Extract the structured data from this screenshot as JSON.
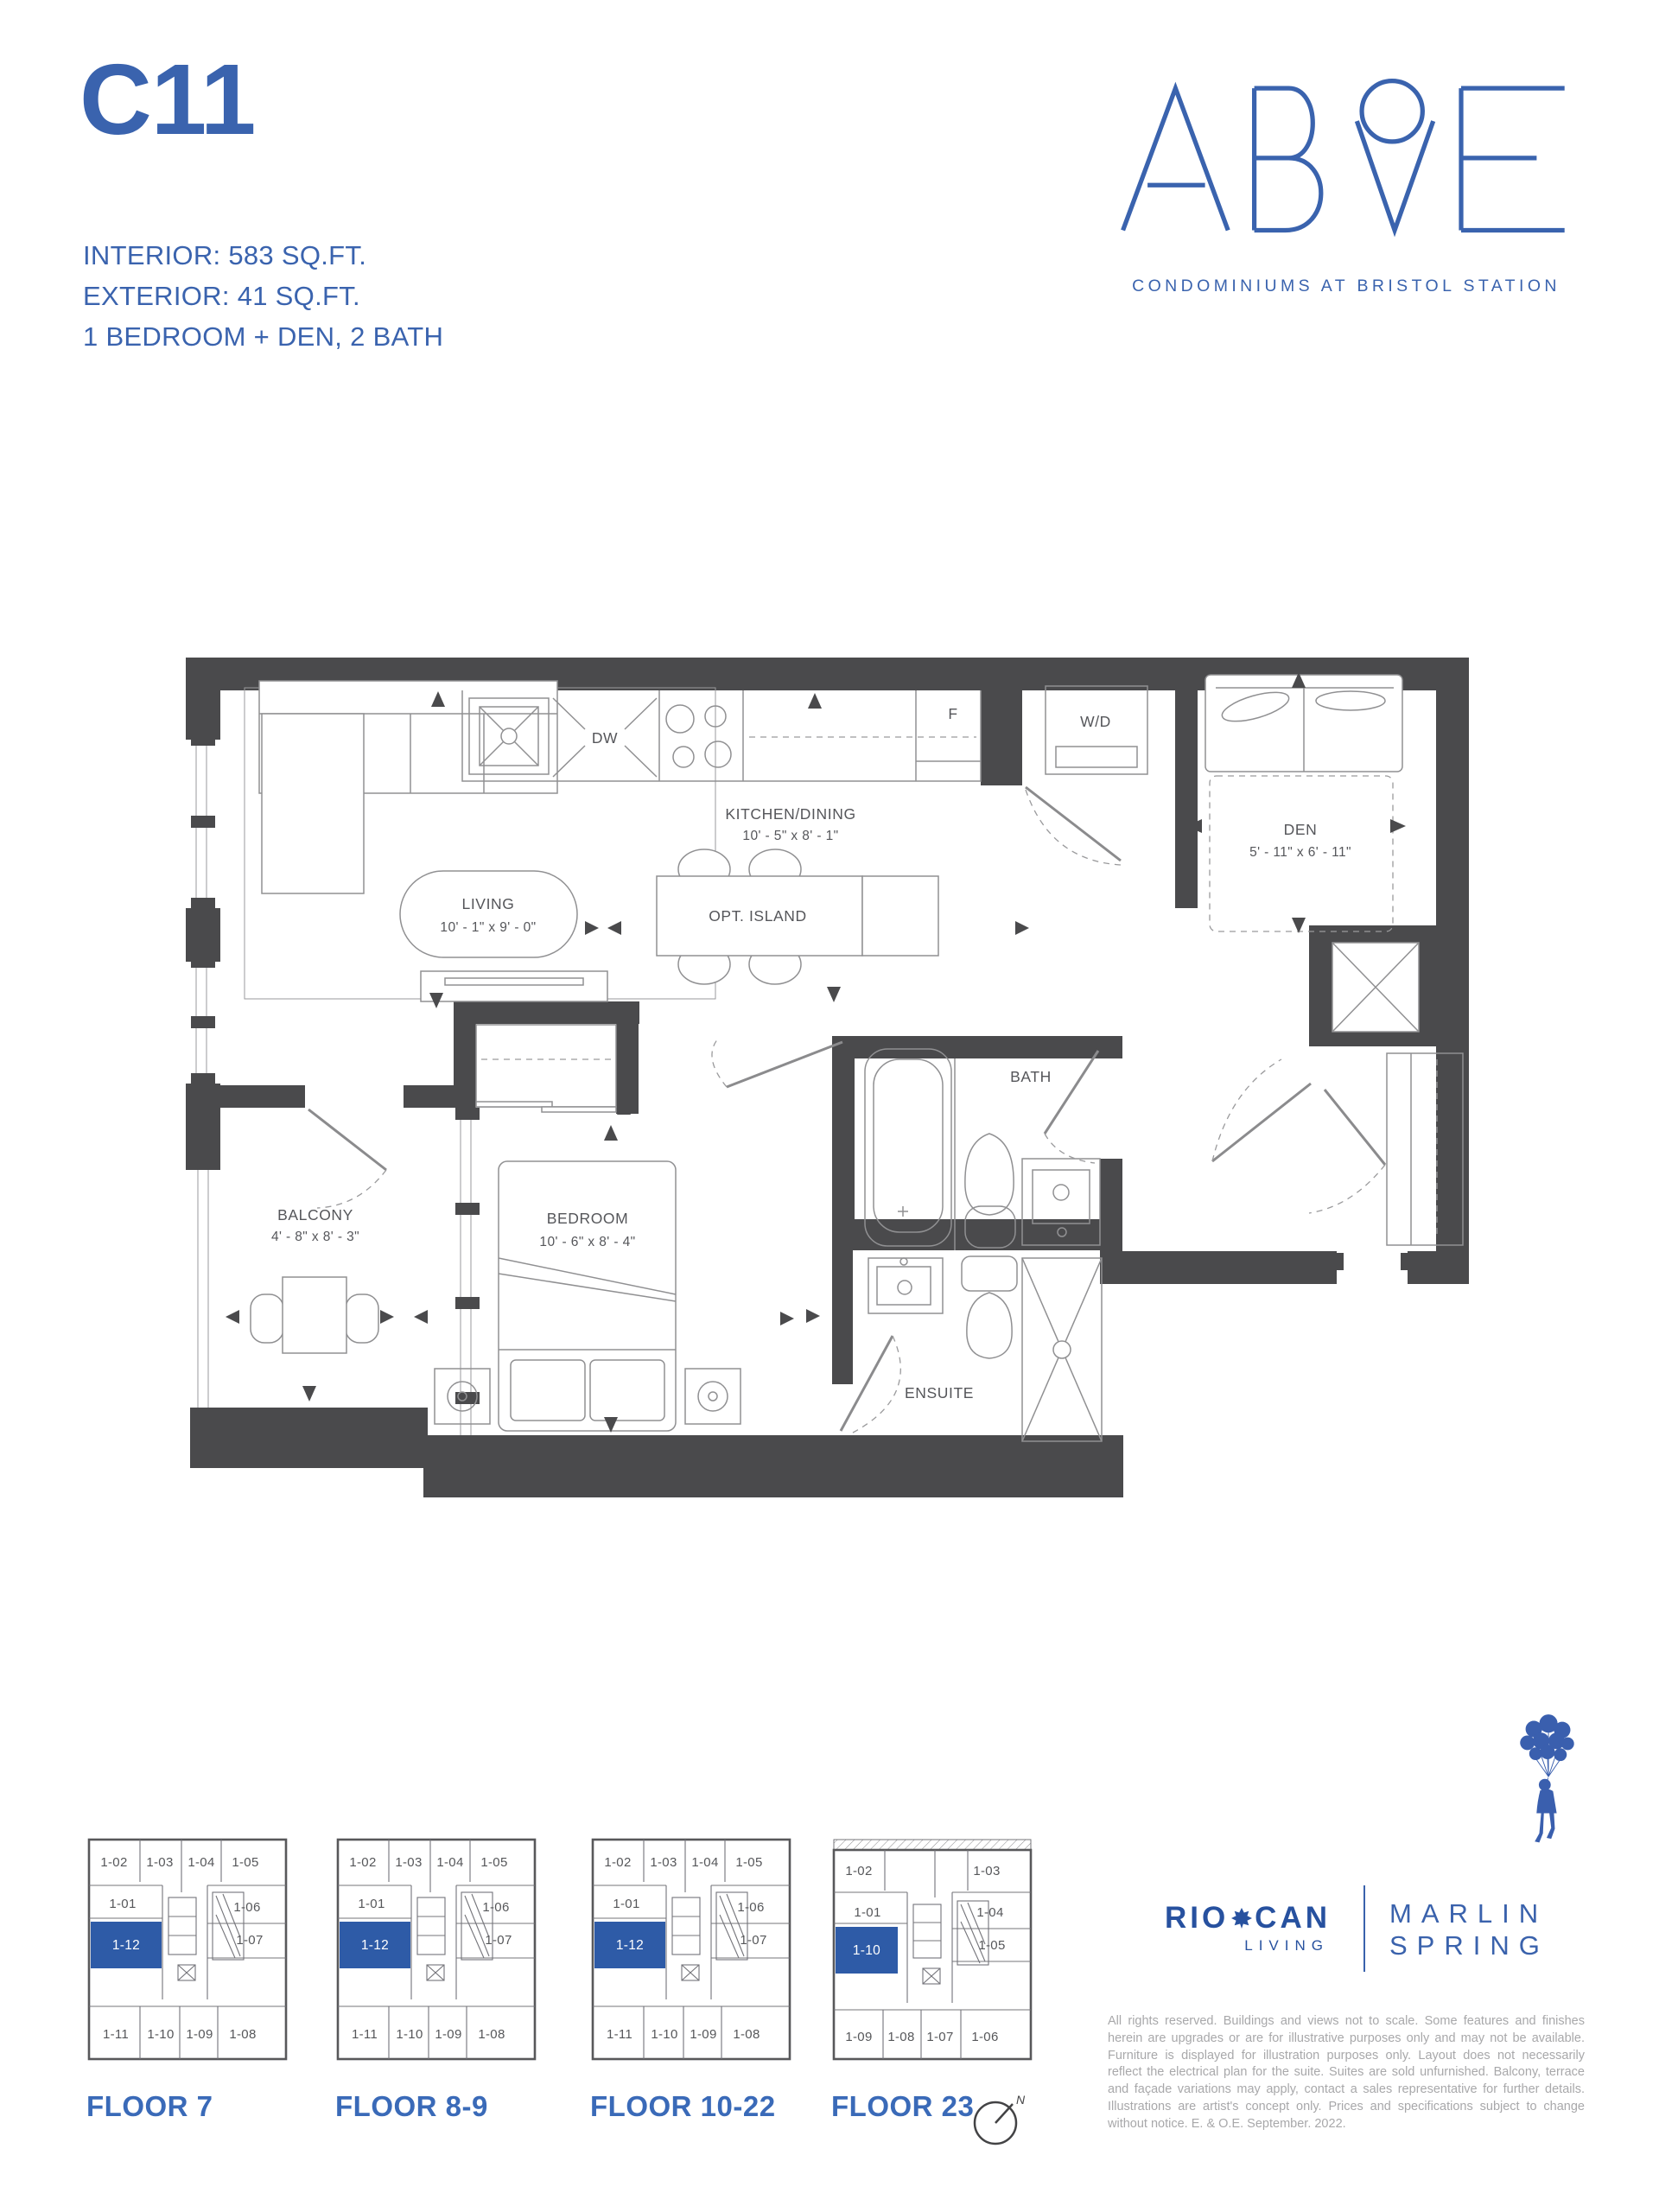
{
  "header": {
    "unit_code": "C11",
    "spec_lines": [
      "INTERIOR: 583 SQ.FT.",
      "EXTERIOR: 41 SQ.FT.",
      "1 BEDROOM + DEN, 2 BATH"
    ]
  },
  "brand": {
    "name": "ABOVE",
    "tagline": "CONDOMINIUMS AT BRISTOL STATION"
  },
  "floorplan": {
    "living": {
      "name": "LIVING",
      "dims": "10' - 1\" x 9' - 0\""
    },
    "kitchen": {
      "name": "KITCHEN/DINING",
      "dims": "10' - 5\" x 8' - 1\""
    },
    "island": {
      "name": "OPT. ISLAND"
    },
    "dw": "DW",
    "fridge": "F",
    "wd": "W/D",
    "den": {
      "name": "DEN",
      "dims": "5' - 11\" x 6' - 11\""
    },
    "bath": {
      "name": "BATH"
    },
    "bedroom": {
      "name": "BEDROOM",
      "dims": "10' - 6\" x 8' - 4\""
    },
    "ensuite": {
      "name": "ENSUITE"
    },
    "balcony": {
      "name": "BALCONY",
      "dims": "4' - 8\" x 8' - 3\""
    }
  },
  "keyplans": [
    {
      "floor_label": "FLOOR 7",
      "highlight_unit": "1-12",
      "units": [
        "1-02",
        "1-03",
        "1-04",
        "1-05",
        "1-01",
        "1-06",
        "1-07",
        "1-11",
        "1-10",
        "1-09",
        "1-08"
      ]
    },
    {
      "floor_label": "FLOOR 8-9",
      "highlight_unit": "1-12",
      "units": [
        "1-02",
        "1-03",
        "1-04",
        "1-05",
        "1-01",
        "1-06",
        "1-07",
        "1-11",
        "1-10",
        "1-09",
        "1-08"
      ]
    },
    {
      "floor_label": "FLOOR 10-22",
      "highlight_unit": "1-12",
      "units": [
        "1-02",
        "1-03",
        "1-04",
        "1-05",
        "1-01",
        "1-06",
        "1-07",
        "1-11",
        "1-10",
        "1-09",
        "1-08"
      ]
    },
    {
      "floor_label": "FLOOR 23",
      "highlight_unit": "1-10",
      "units": [
        "1-02",
        "1-03",
        "1-01",
        "1-04",
        "1-05",
        "1-09",
        "1-08",
        "1-07",
        "1-06"
      ]
    }
  ],
  "compass": {
    "label": "N"
  },
  "footer": {
    "riocan": {
      "left": "RIO",
      "right": "CAN",
      "sub": "LIVING"
    },
    "marlin": {
      "line1": "MARLIN",
      "line2": "SPRING"
    },
    "disclaimer": "All rights reserved. Buildings and views not to scale. Some features and finishes herein are upgrades or are for illustrative purposes only and may not be available. Furniture is displayed for illustration purposes only. Layout does not necessarily reflect the electrical plan for the suite. Suites are sold unfurnished. Balcony, terrace and façade variations may apply, contact a sales representative for further details. Illustrations are artist's concept only. Prices and specifications subject to change without notice. E. & O.E. September. 2022."
  },
  "colors": {
    "accent_blue": "#3a63ae",
    "highlight_blue": "#2e5ba7",
    "wall_gray": "#4a4a4c"
  }
}
